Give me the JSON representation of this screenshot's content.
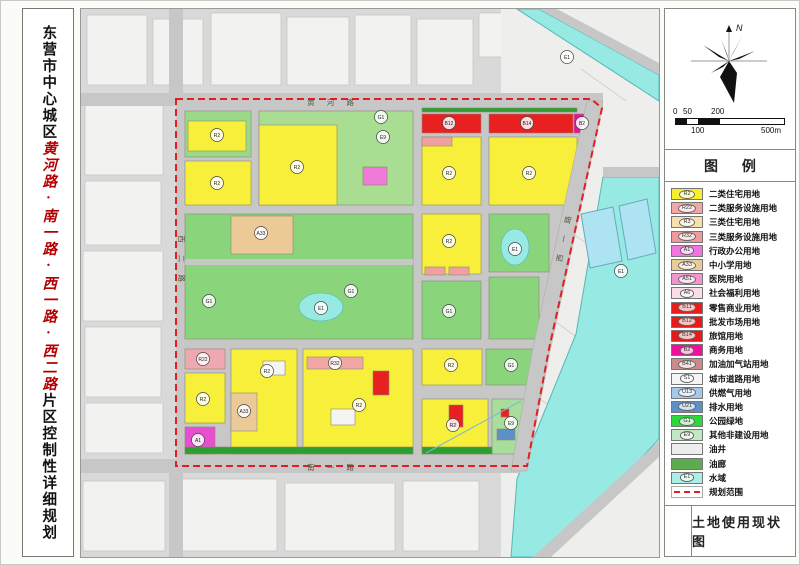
{
  "colors": {
    "title_red": "#b40000",
    "boundary_red": "#e02020",
    "water": "#97e9e4",
    "park_green": "#8ad47c",
    "residential_yellow": "#f7ef3a",
    "road_gray": "#c7c7c7"
  },
  "left_title": {
    "part1": "东营市中心城区",
    "part2": "黄河路·南一路·西一路·西二路",
    "part3": "片区控制性详细规划"
  },
  "compass": {
    "north_label": "N"
  },
  "scale_bar": {
    "l0": "0",
    "l1": "50",
    "l2": "100",
    "l3": "200",
    "l4": "500m"
  },
  "legend": {
    "title": "图  例",
    "items": [
      {
        "code": "R2",
        "label": "二类住宅用地",
        "color": "#f7ef2e",
        "type": "fill"
      },
      {
        "code": "R22",
        "label": "二类服务设施用地",
        "color": "#f2a6a6",
        "type": "fill"
      },
      {
        "code": "R3",
        "label": "三类住宅用地",
        "color": "#f6e0ae",
        "type": "fill"
      },
      {
        "code": "R32",
        "label": "三类服务设施用地",
        "color": "#ef9a9a",
        "type": "fill"
      },
      {
        "code": "A1",
        "label": "行政办公用地",
        "color": "#f075e0",
        "type": "fill"
      },
      {
        "code": "A33",
        "label": "中小学用地",
        "color": "#eaca96",
        "type": "fill"
      },
      {
        "code": "A51",
        "label": "医院用地",
        "color": "#f295cc",
        "type": "fill"
      },
      {
        "code": "A6",
        "label": "社会福利用地",
        "color": "#fadde9",
        "type": "fill"
      },
      {
        "code": "B11",
        "label": "零售商业用地",
        "color": "#ec1c1c",
        "type": "fill"
      },
      {
        "code": "B12",
        "label": "批发市场用地",
        "color": "#e61a1a",
        "type": "fill"
      },
      {
        "code": "B14",
        "label": "旅馆用地",
        "color": "#e61a1a",
        "type": "fill"
      },
      {
        "code": "B2",
        "label": "商务用地",
        "color": "#ee109a",
        "type": "fill"
      },
      {
        "code": "B41",
        "label": "加油加气站用地",
        "color": "#c98b8b",
        "type": "fill"
      },
      {
        "code": "S1",
        "label": "城市道路用地",
        "color": "#f5f5f5",
        "type": "fill"
      },
      {
        "code": "U13",
        "label": "供燃气用地",
        "color": "#a5c8ea",
        "type": "fill"
      },
      {
        "code": "U21",
        "label": "排水用地",
        "color": "#5e90c8",
        "type": "fill"
      },
      {
        "code": "G1",
        "label": "公园绿地",
        "color": "#2bd93a",
        "type": "fill"
      },
      {
        "code": "E9",
        "label": "其他非建设用地",
        "color": "#c0e8c2",
        "type": "fill"
      },
      {
        "code": "",
        "label": "油井",
        "color": "#ededed",
        "type": "fill"
      },
      {
        "code": "",
        "label": "油廊",
        "color": "#5cab4e",
        "type": "fill"
      },
      {
        "code": "E1",
        "label": "水域",
        "color": "#a9efe8",
        "type": "fill"
      },
      {
        "code": "",
        "label": "规划范围",
        "color": "#ffffff",
        "type": "dashed"
      }
    ]
  },
  "footer": {
    "map_title": "土地使用现状图"
  },
  "map": {
    "road_labels": [
      {
        "x": 252,
        "y": 96,
        "rot": 0,
        "t": "黄 河 路"
      },
      {
        "x": 98,
        "y": 252,
        "rot": 90,
        "t": "西 二 路"
      },
      {
        "x": 486,
        "y": 228,
        "rot": -78,
        "t": "西 一 路"
      },
      {
        "x": 252,
        "y": 461,
        "rot": 0,
        "t": "南 一 路"
      }
    ],
    "zone_codes": [
      {
        "x": 136,
        "y": 126,
        "t": "R2"
      },
      {
        "x": 136,
        "y": 174,
        "t": "R2"
      },
      {
        "x": 216,
        "y": 158,
        "t": "R2"
      },
      {
        "x": 302,
        "y": 128,
        "t": "E9"
      },
      {
        "x": 300,
        "y": 108,
        "t": "G1"
      },
      {
        "x": 368,
        "y": 114,
        "t": "B12"
      },
      {
        "x": 446,
        "y": 114,
        "t": "B14"
      },
      {
        "x": 501,
        "y": 114,
        "t": "B2"
      },
      {
        "x": 368,
        "y": 164,
        "t": "R2"
      },
      {
        "x": 448,
        "y": 164,
        "t": "R2"
      },
      {
        "x": 180,
        "y": 224,
        "t": "A33"
      },
      {
        "x": 128,
        "y": 292,
        "t": "G1"
      },
      {
        "x": 270,
        "y": 282,
        "t": "G1"
      },
      {
        "x": 240,
        "y": 299,
        "t": "E1"
      },
      {
        "x": 368,
        "y": 232,
        "t": "R2"
      },
      {
        "x": 368,
        "y": 302,
        "t": "G1"
      },
      {
        "x": 434,
        "y": 240,
        "t": "E1"
      },
      {
        "x": 122,
        "y": 350,
        "t": "R22"
      },
      {
        "x": 122,
        "y": 390,
        "t": "R2"
      },
      {
        "x": 117,
        "y": 431,
        "t": "A1"
      },
      {
        "x": 163,
        "y": 402,
        "t": "A33"
      },
      {
        "x": 186,
        "y": 362,
        "t": "R2"
      },
      {
        "x": 278,
        "y": 396,
        "t": "R2"
      },
      {
        "x": 254,
        "y": 354,
        "t": "R32"
      },
      {
        "x": 370,
        "y": 356,
        "t": "R2"
      },
      {
        "x": 430,
        "y": 356,
        "t": "G1"
      },
      {
        "x": 372,
        "y": 416,
        "t": "R2"
      },
      {
        "x": 430,
        "y": 414,
        "t": "E9"
      },
      {
        "x": 540,
        "y": 262,
        "t": "E1"
      },
      {
        "x": 486,
        "y": 48,
        "t": "E1"
      }
    ]
  }
}
